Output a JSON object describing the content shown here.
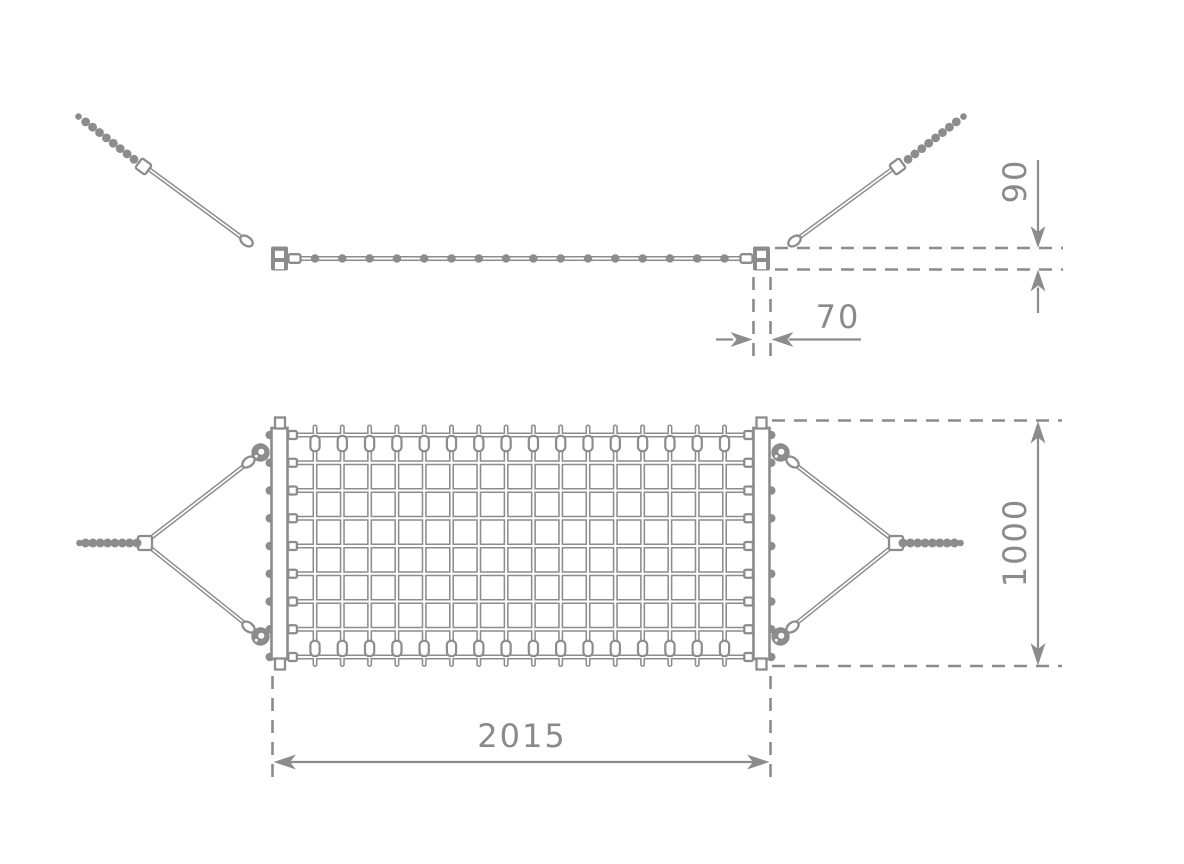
{
  "colors": {
    "background": "#ffffff",
    "line": "#8c8c8c",
    "text": "#8a8a8a"
  },
  "side_view": {
    "tube_bead_count": 16
  },
  "plan_view": {
    "net_columns": 16,
    "net_rows": 9
  },
  "dimensions": {
    "d90": {
      "label": "90",
      "orientation": "vertical"
    },
    "d70": {
      "label": "70",
      "orientation": "horizontal"
    },
    "d2015": {
      "label": "2015",
      "orientation": "horizontal"
    },
    "d1000": {
      "label": "1000",
      "orientation": "vertical"
    }
  }
}
